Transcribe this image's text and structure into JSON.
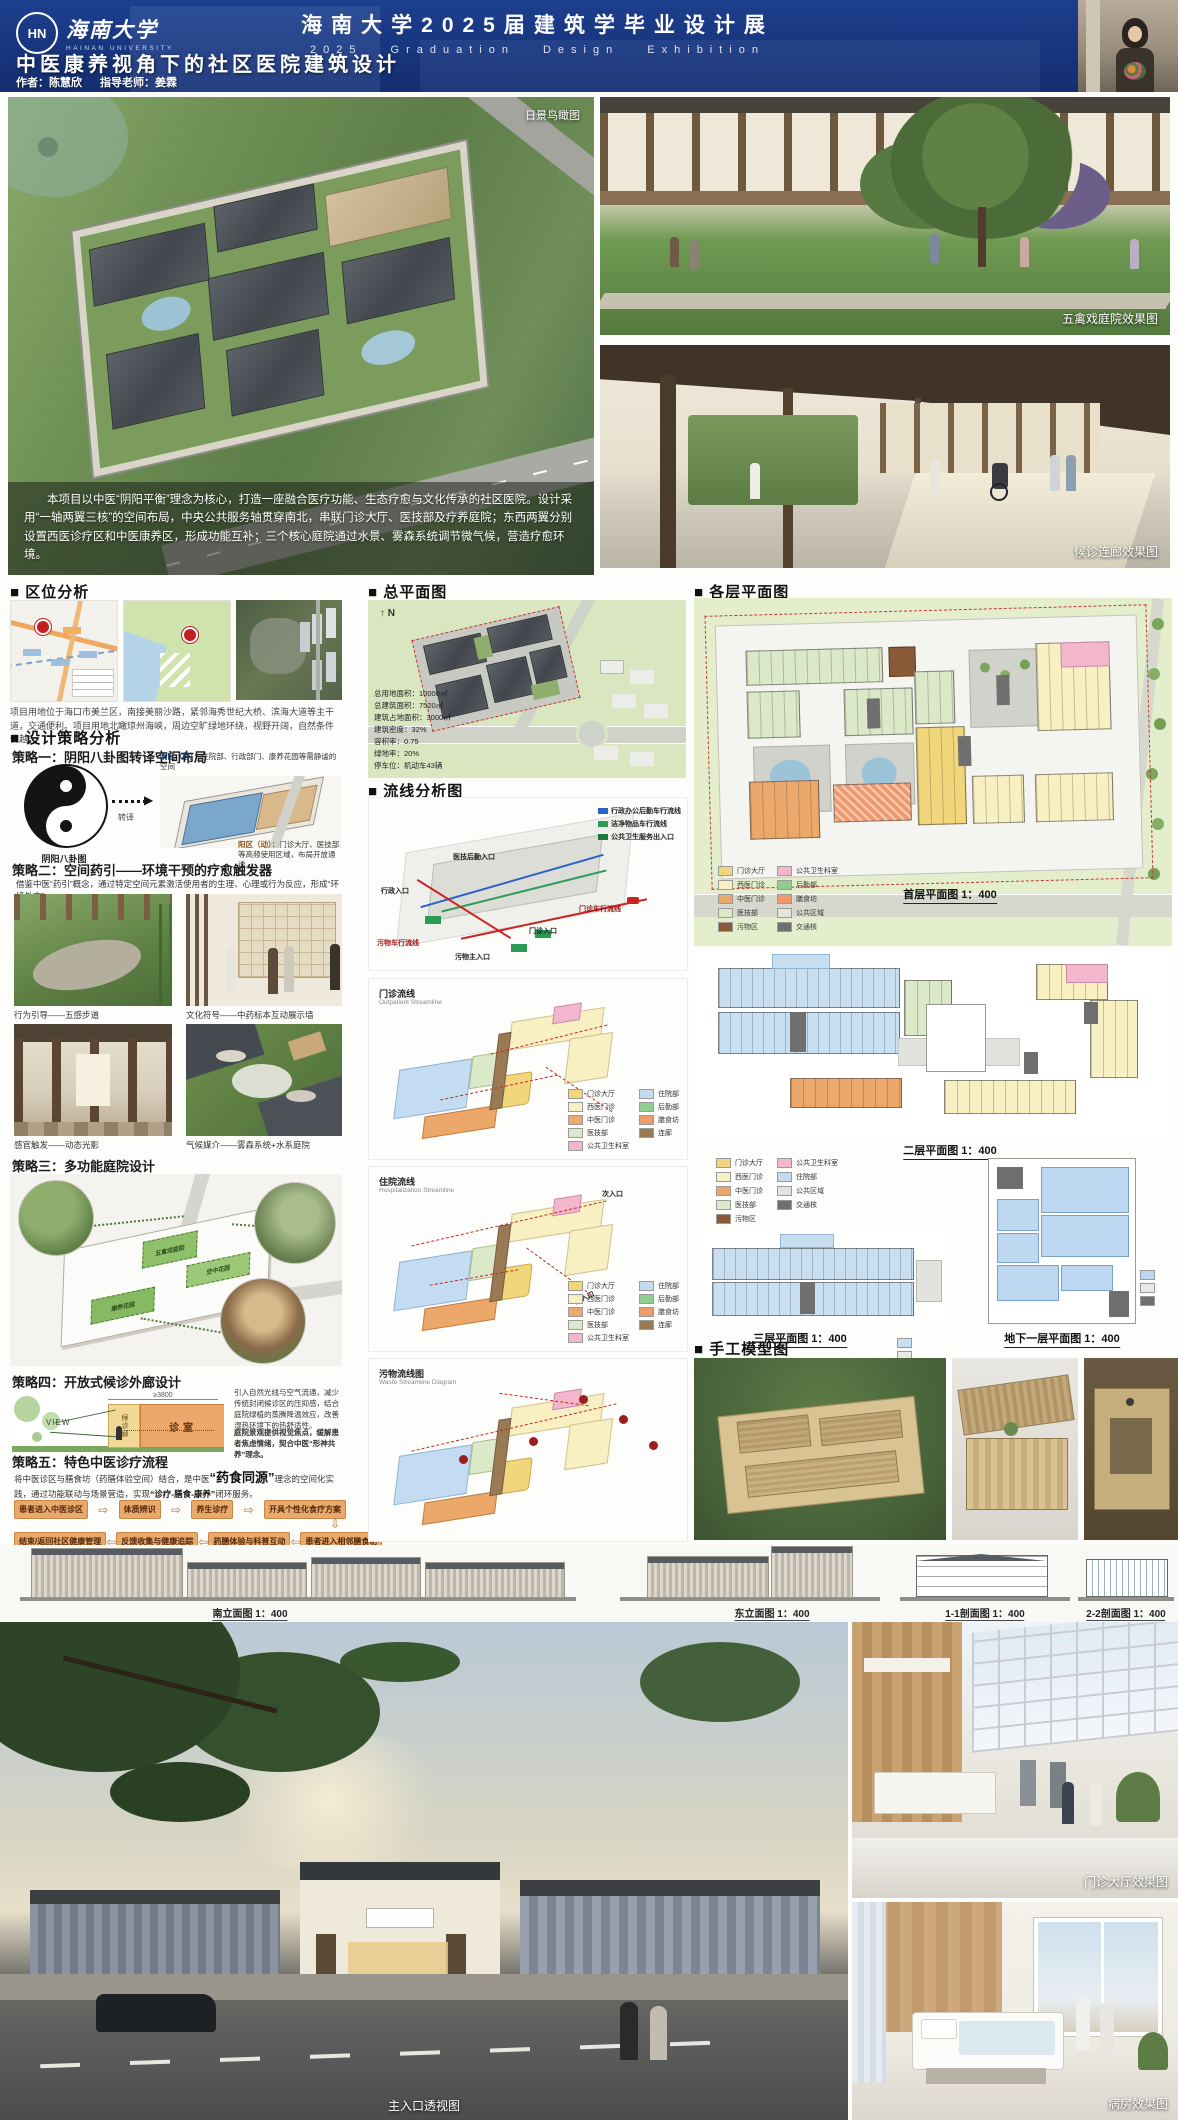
{
  "header": {
    "logo_cn": "海南大学",
    "logo_en": "HAINAN UNIVERSITY",
    "logo_mark": "HN",
    "expo_title": "海南大学2025届建筑学毕业设计展",
    "expo_subtitle": "2025  Graduation  Design  Exhibition",
    "project_title": "中医康养视角下的社区医院建筑设计",
    "author": "作者：陈慧欣",
    "advisor": "指导老师：姜霖"
  },
  "hero": {
    "aerial_label": "日景鸟瞰图",
    "intro": "本项目以中医“阴阳平衡”理念为核心，打造一座融合医疗功能、生态疗愈与文化传承的社区医院。设计采用“一轴两翼三核”的空间布局，中央公共服务轴贯穿南北，串联门诊大厅、医技部及疗养庭院；东西两翼分别设置西医诊疗区和中医康养区，形成功能互补；三个核心庭院通过水景、雾森系统调节微气候，营造疗愈环境。",
    "courtyard_label": "五禽戏庭院效果图",
    "corridor_label": "候诊连廊效果图"
  },
  "location": {
    "title": "■ 区位分析",
    "caption": "项目用地位于海口市美兰区，南接美丽沙路，紧邻海秀世纪大桥、滨海大道等主干道，交通便利。项目用地北瞰琼州海峡，周边空旷绿地环绕，视野开阔，自然条件优越。"
  },
  "strategies": {
    "title": "■ 设计策略分析",
    "s1": {
      "title": "策略一：阴阳八卦图转译空间布局",
      "taiji_caption": "阴阳八卦图",
      "arrow_label": "转译",
      "yin_title": "阴区（静）：",
      "yin_desc": "住院部、行政部门、康养花园等需静谧的空间",
      "yang_title": "阳区（动）：",
      "yang_desc": "门诊大厅、医技部等高频使用区域，布局开放通透。"
    },
    "s2": {
      "title": "策略二：空间药引——环境干预的疗愈触发器",
      "desc": "借鉴中医“药引”概念，通过特定空间元素激活使用者的生理、心理或行为反应，形成“环境处方”。",
      "photos": [
        {
          "caption": "行为引导——五感步道"
        },
        {
          "caption": "文化符号——中药标本互动展示墙"
        },
        {
          "caption": "感官触发——动态光影"
        },
        {
          "caption": "气候媒介——雾森系统+水系庭院"
        }
      ]
    },
    "s3": {
      "title": "策略三：多功能庭院设计",
      "courtyards": [
        "五禽戏庭院",
        "空中花园",
        "康养花园"
      ]
    },
    "s4": {
      "title": "策略四：开放式候诊外廊设计",
      "view_label": "VIEW",
      "dim_label": "≥3800",
      "waiting_label": "候诊廊",
      "room_label": "诊室",
      "para1": "引入自然光线与空气流通，减少传统封闭候诊区的压抑感，结合庭院绿植的蒸腾降温效应，改善湿热环境下的热舒适性。",
      "para2": "庭院景观提供视觉焦点，缓解患者焦虑情绪，契合中医“形神共养”理念。"
    },
    "s5": {
      "title": "策略五：特色中医诊疗流程",
      "desc_1": "将中医诊区与膳食坊（药膳体验空间）结合，是中医",
      "desc_hl": "“药食同源”",
      "desc_2": "理念的空间化实践，通过功能联动与场景营造，实现",
      "desc_hl2": "“诊疗-膳食-康养”",
      "desc_3": "闭环服务。",
      "flow_top": [
        "患者进入中医诊区",
        "体质辨识",
        "养生诊疗",
        "开具个性化食疗方案"
      ],
      "flow_bottom": [
        "结束/返回社区健康管理",
        "反馈收集与健康追踪",
        "药膳体验与科普互动",
        "患者进入相邻膳食坊"
      ]
    }
  },
  "master_plan": {
    "title": "■ 总平面图",
    "north_label": "N",
    "stats": [
      "总用地面积：10000㎡",
      "总建筑面积：7520㎡",
      "建筑占地面积：3000㎡",
      "建筑密度：32%",
      "容积率：0.75",
      "绿地率：20%",
      "停车位：机动车43辆"
    ]
  },
  "circulation": {
    "title": "■ 流线分析图",
    "d1": {
      "labels_right": [
        "行政办公后勤车行流线",
        "洁净物品车行流线",
        "公共卫生服务出入口"
      ],
      "labels_left": [
        "医技后勤入口",
        "行政入口"
      ],
      "label_outpatient_flow": "门诊车行流线",
      "label_outpatient_entry": "门诊入口",
      "label_waste_flow": "污物车行流线",
      "label_waste_entry": "污物主入口"
    },
    "d2": {
      "name": "门诊流线",
      "en": "Outpatient Streamline"
    },
    "d3": {
      "name": "住院流线",
      "en": "Hospitalization Streamline",
      "entry1": "次入口",
      "entry2": "主入口"
    },
    "d4": {
      "name": "污物流线图",
      "en": "Waste Streamline Diagram"
    },
    "legend": [
      {
        "label": "门诊大厅",
        "color": "#f1d67c"
      },
      {
        "label": "西医门诊",
        "color": "#f8efc3"
      },
      {
        "label": "中医门诊",
        "color": "#eca76b"
      },
      {
        "label": "医技部",
        "color": "#dce9c8"
      },
      {
        "label": "公共卫生科室",
        "color": "#f2b6cd"
      },
      {
        "label": "住院部",
        "color": "#c4dcf1"
      },
      {
        "label": "后勤部",
        "color": "#90cd92"
      },
      {
        "label": "膳食坊",
        "color": "#ee9a6e"
      },
      {
        "label": "连廊",
        "color": "#9a7a55"
      }
    ]
  },
  "floor_plans": {
    "title": "■ 各层平面图",
    "f1_label": "首层平面图 1：400",
    "f2_label": "二层平面图 1：400",
    "f3_label": "三层平面图 1：400",
    "b1_label": "地下一层平面图 1：400",
    "legend_f1": [
      {
        "label": "门诊大厅",
        "color": "#f1d67c"
      },
      {
        "label": "西医门诊",
        "color": "#f8efc3"
      },
      {
        "label": "中医门诊",
        "color": "#eca76b"
      },
      {
        "label": "医技部",
        "color": "#dce9c8"
      },
      {
        "label": "污物区",
        "color": "#8a5a38"
      },
      {
        "label": "公共卫生科室",
        "color": "#f2b6cd"
      },
      {
        "label": "后勤部",
        "color": "#90cd92"
      },
      {
        "label": "膳食坊",
        "color": "#ee9a6e"
      },
      {
        "label": "公共区域",
        "color": "#e3e3df"
      },
      {
        "label": "交通核",
        "color": "#6f6f6f"
      }
    ],
    "legend_f2": [
      {
        "label": "门诊大厅",
        "color": "#f1d67c"
      },
      {
        "label": "西医门诊",
        "color": "#f8efc3"
      },
      {
        "label": "中医门诊",
        "color": "#eca76b"
      },
      {
        "label": "医技部",
        "color": "#dce9c8"
      },
      {
        "label": "污物区",
        "color": "#8a5a38"
      },
      {
        "label": "公共卫生科室",
        "color": "#f2b6cd"
      },
      {
        "label": "住院部",
        "color": "#c4dcf1"
      },
      {
        "label": "公共区域",
        "color": "#e3e3df"
      },
      {
        "label": "交通核",
        "color": "#6f6f6f"
      }
    ]
  },
  "models": {
    "title": "■ 手工模型图"
  },
  "elevations": {
    "south": "南立面图 1：400",
    "east": "东立面图 1：400",
    "sec11": "1-1剖面图 1：400",
    "sec22": "2-2剖面图 1：400"
  },
  "bottom": {
    "entrance_label": "主入口透视图",
    "lobby_label": "门诊大厅效果图",
    "ward_label": "病房效果图"
  }
}
